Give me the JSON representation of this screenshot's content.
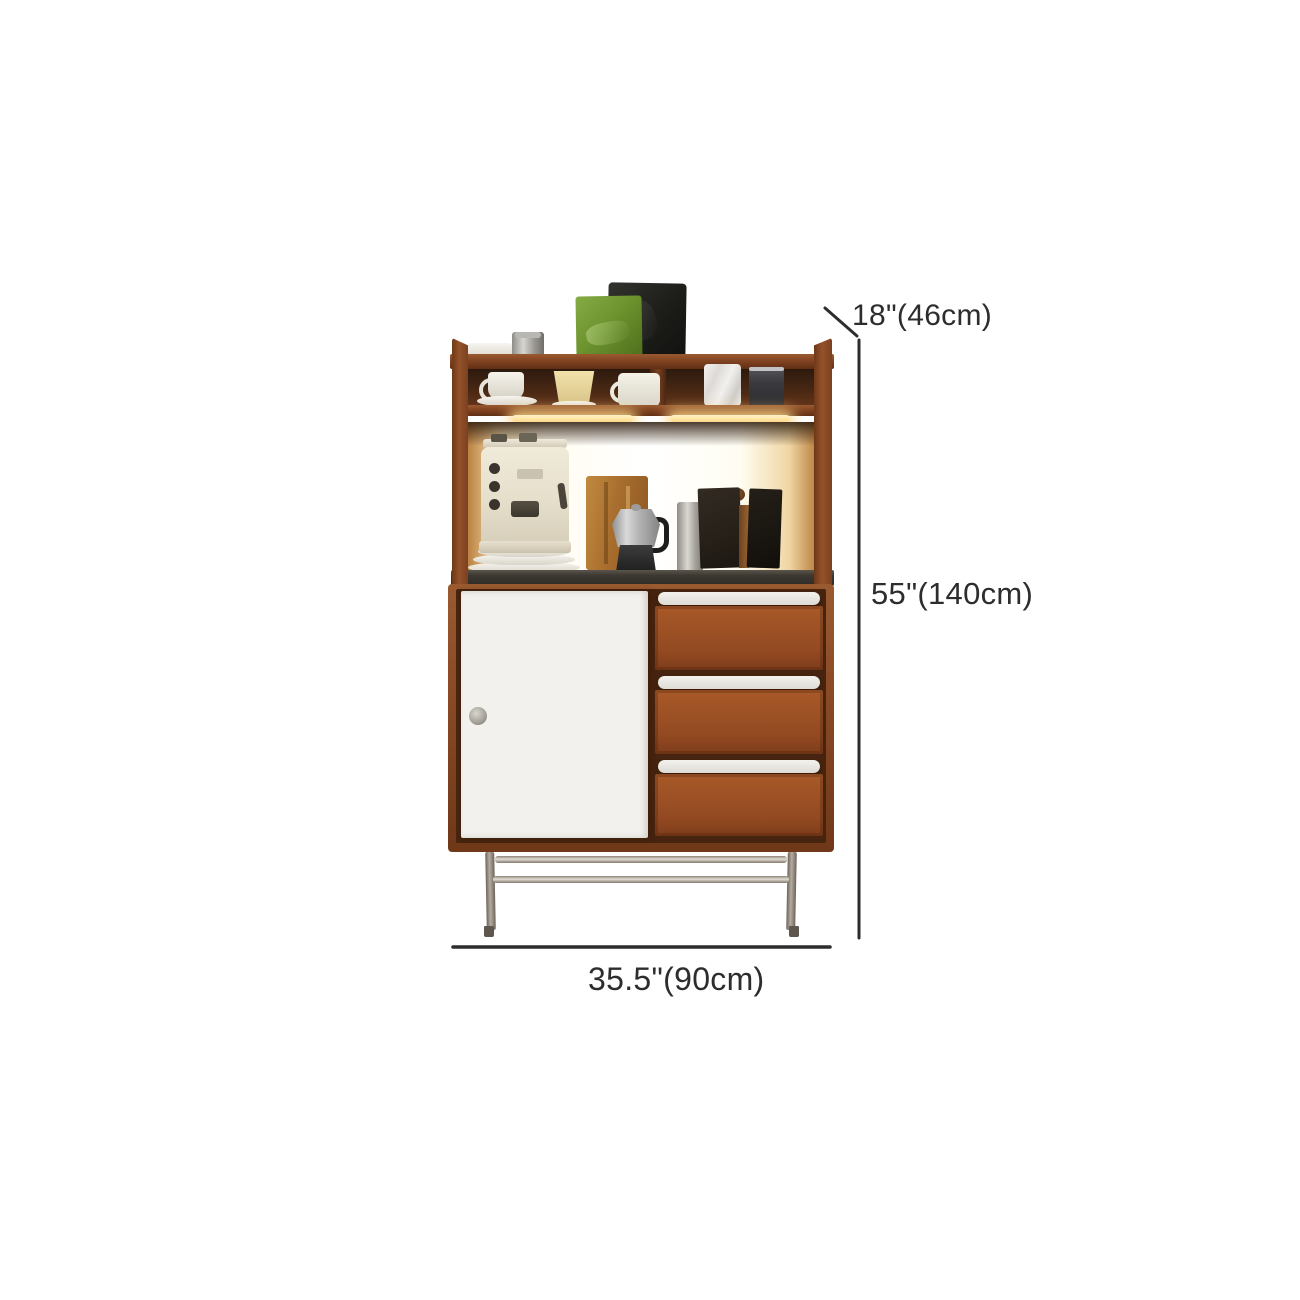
{
  "canvas": {
    "width": 1300,
    "height": 1300,
    "background": "#ffffff"
  },
  "annotations": {
    "depth_label": "18\"(46cm)",
    "height_label": "55\"(140cm)",
    "width_label": "35.5\"(90cm)",
    "line_color": "#2d2d2d",
    "text_color": "#2d2d2d"
  },
  "product": {
    "type": "coffee-bar-cabinet-with-hutch",
    "palette": {
      "wood": "#8b4a26",
      "wood_dark": "#5c3118",
      "drawer_face": "#9e5126",
      "door_white": "#f2f1ed",
      "countertop": "#3c3831",
      "led_glow": "#ffd98a",
      "backlight": "#fffcf0",
      "metal_leg": "#b4aca2",
      "bag_green": "#6d942f",
      "bag_black": "#232320"
    },
    "decor_items": [
      "white-cloth",
      "metal-canister",
      "green-coffee-bag",
      "black-coffee-bag",
      "teacup-with-saucer",
      "yellow-mug",
      "white-mug",
      "marble-mug",
      "black-tin-mug",
      "espresso-machine",
      "plate-stack",
      "paper-bag",
      "moka-pot",
      "coffee-grinder",
      "dark-book-boards"
    ]
  }
}
